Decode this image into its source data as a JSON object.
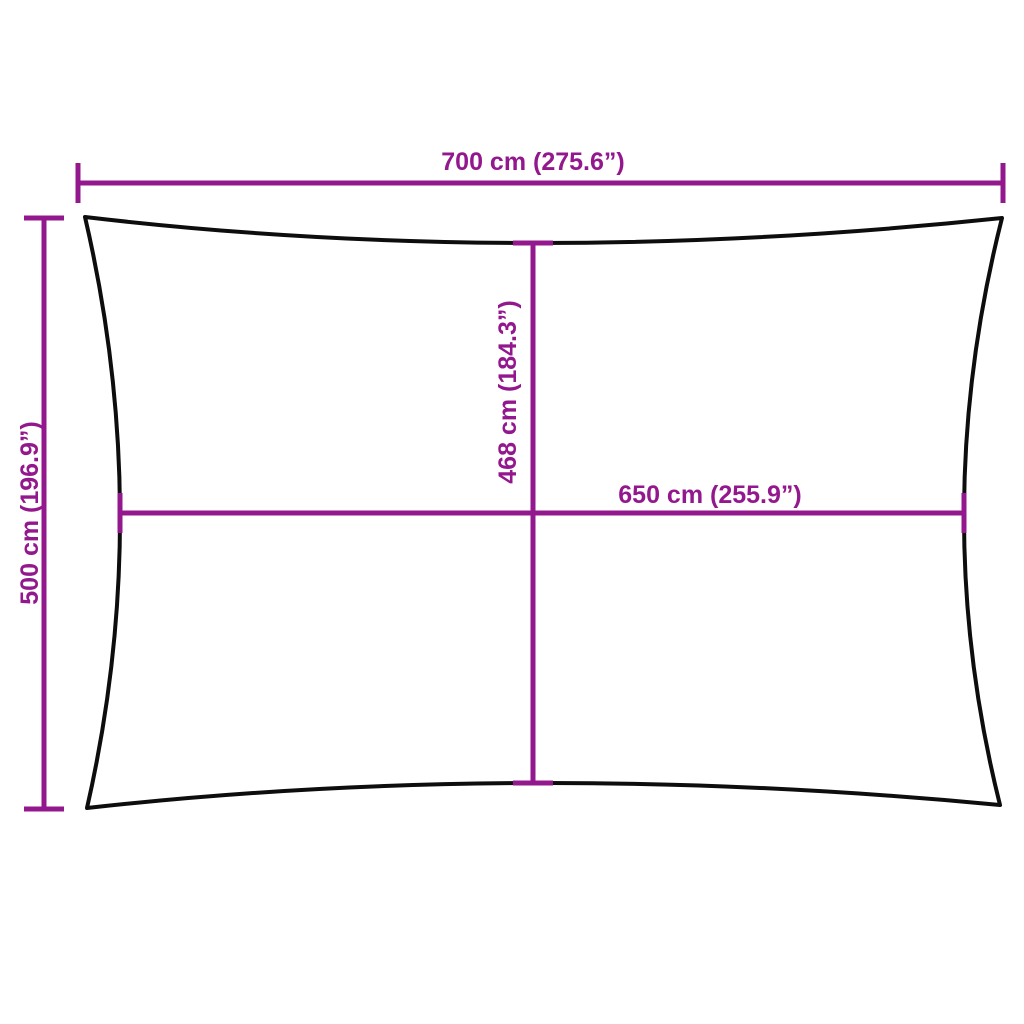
{
  "diagram": {
    "name": "shade-sail-dimension-diagram",
    "colors": {
      "dimension": "#93188E",
      "outline": "#0D0D0D",
      "background": "#FFFFFF"
    },
    "dimensions": {
      "overall_width": {
        "cm": 700,
        "inches": 275.6,
        "label": "700 cm (275.6”)"
      },
      "overall_height": {
        "cm": 500,
        "inches": 196.9,
        "label": "500 cm (196.9”)"
      },
      "inner_height": {
        "cm": 468,
        "inches": 184.3,
        "label": "468 cm (184.3”)"
      },
      "inner_width": {
        "cm": 650,
        "inches": 255.9,
        "label": "650 cm (255.9”)"
      }
    }
  }
}
